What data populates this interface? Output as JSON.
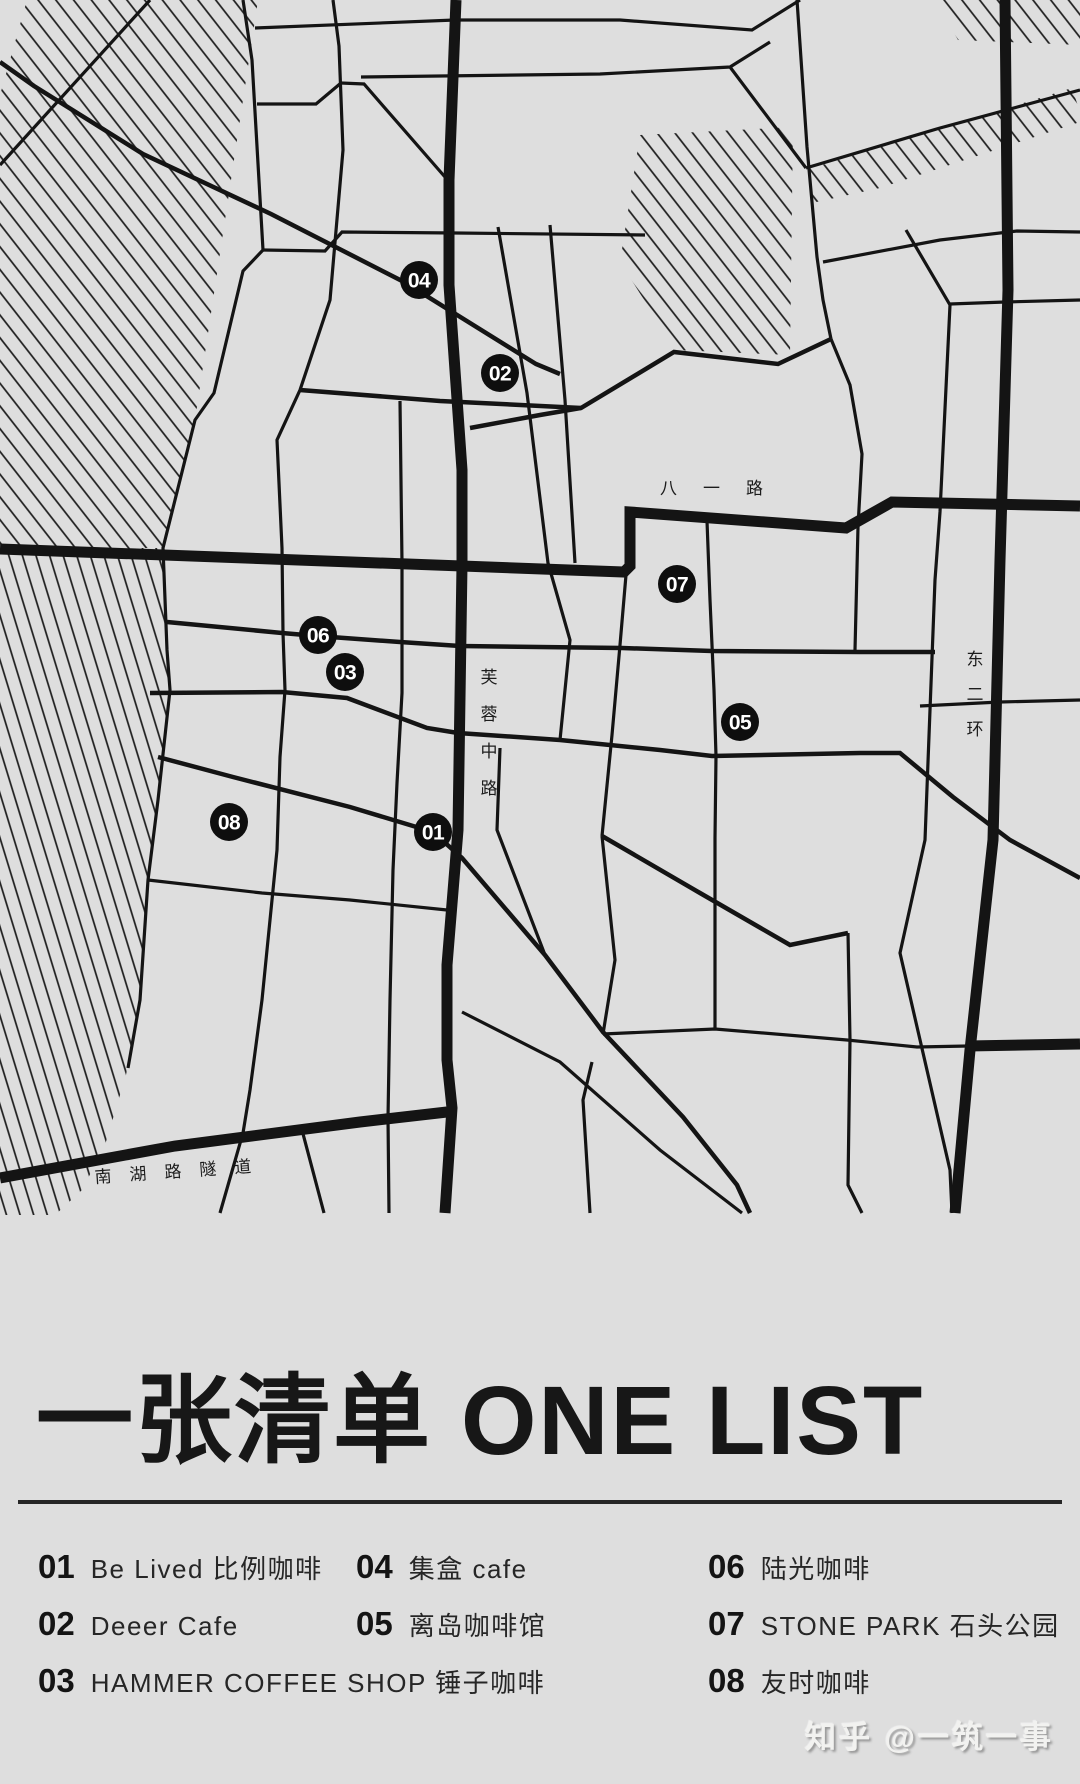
{
  "colors": {
    "background": "#dedede",
    "road": "#141414",
    "marker_fill": "#0e0e0e",
    "marker_text": "#ffffff",
    "title_text": "#171717",
    "watermark_text": "#f2f2f0"
  },
  "title": {
    "text": "一张清单 ONE LIST"
  },
  "watermark": {
    "text": "知乎 @一筑一事"
  },
  "list": {
    "columns": [
      [
        {
          "num": "01",
          "name": "Be Lived 比例咖啡"
        },
        {
          "num": "02",
          "name": "Deeer Cafe"
        },
        {
          "num": "03",
          "name": "HAMMER COFFEE SHOP 锤子咖啡"
        }
      ],
      [
        {
          "num": "04",
          "name": "集盒 cafe"
        },
        {
          "num": "05",
          "name": "离岛咖啡馆"
        }
      ],
      [
        {
          "num": "06",
          "name": "陆光咖啡"
        },
        {
          "num": "07",
          "name": "STONE PARK 石头公园"
        },
        {
          "num": "08",
          "name": "友时咖啡"
        }
      ]
    ]
  },
  "map": {
    "width": 1080,
    "height": 1216,
    "road_labels": [
      {
        "id": "bayi-road-label",
        "text": "八一路",
        "x": 660,
        "y": 494,
        "fontSize": 17,
        "letterSpacing": 26,
        "rotate": 0
      },
      {
        "id": "nanhu-tunnel-label",
        "text": "南湖路隧道",
        "x": 95,
        "y": 1183,
        "fontSize": 17,
        "letterSpacing": 18,
        "rotate": -4
      },
      {
        "id": "furong-road-label",
        "text": "芙蓉中路",
        "x": 489,
        "y": 683,
        "vertical": true,
        "step": 37,
        "fontSize": 17
      },
      {
        "id": "east-2nd-ring-label",
        "text": "东二环",
        "x": 975,
        "y": 665,
        "vertical": true,
        "step": 35,
        "fontSize": 17
      }
    ],
    "markers": [
      {
        "id": "01",
        "x": 433,
        "y": 832
      },
      {
        "id": "02",
        "x": 500,
        "y": 373
      },
      {
        "id": "03",
        "x": 345,
        "y": 672
      },
      {
        "id": "04",
        "x": 419,
        "y": 280
      },
      {
        "id": "05",
        "x": 740,
        "y": 722
      },
      {
        "id": "06",
        "x": 318,
        "y": 635
      },
      {
        "id": "07",
        "x": 677,
        "y": 584
      },
      {
        "id": "08",
        "x": 229,
        "y": 822
      }
    ],
    "marker_radius": 19,
    "hatches": [
      {
        "points": "27,0 258,0 222,240 195,420 163,548 0,548 0,95",
        "pattern": "hatch1"
      },
      {
        "points": "0,548 163,548 167,650 170,690 158,800 148,880 140,1000 126,1075 105,1145 82,1190 55,1215 0,1215",
        "pattern": "hatch2"
      },
      {
        "points": "935,0 1080,0 1080,45 958,40",
        "pattern": "hatch1"
      },
      {
        "points": "806,170 1072,88 1080,112 1080,122 880,188 812,203",
        "pattern": "hatch1"
      },
      {
        "points": "640,135 793,127 790,355 676,350 620,262",
        "pattern": "hatch1"
      }
    ],
    "roads": [
      {
        "d": "M456,0 L449,180 L449,285 L462,470 L462,565 L458,830 L447,965 L447,1060 L452,1108 L445,1213",
        "w": "thick"
      },
      {
        "d": "M0,549 L624,572 L630,566 L630,512 L846,528 L892,502 L1080,506",
        "w": "thick"
      },
      {
        "d": "M1005,0 L1008,290 L1000,560 L993,840 L970,1050 L955,1213",
        "w": "thick"
      },
      {
        "d": "M0,1178 L175,1146 L360,1122 L447,1112",
        "w": "thick"
      },
      {
        "d": "M968,1046 L1080,1044",
        "w": "thick"
      },
      {
        "d": "M0,62 L34,86 L143,154 L271,214 L404,282 L536,364 L560,374",
        "w": "med"
      },
      {
        "d": "M433,832 L462,858 L545,955 L603,1032 L683,1117 L737,1185 L750,1213",
        "w": "med"
      },
      {
        "d": "M602,836 L700,893 L790,945 L848,933",
        "w": "med"
      },
      {
        "d": "M150,693 L282,692 L347,698 L427,728 L458,733 L560,740 L660,750 L712,756 L860,753 L900,753 L953,797 L1010,840 L1080,878",
        "w": "med"
      },
      {
        "d": "M158,757 L233,777 L350,807 L433,832",
        "w": "med"
      },
      {
        "d": "M167,622 L282,633 L317,636 L400,642 L460,646 L622,648 L712,651 L860,652 L935,652",
        "w": "med"
      },
      {
        "d": "M470,428 L540,415 L581,408 L674,352 L778,364 L831,339",
        "w": "med"
      },
      {
        "d": "M300,390 L440,401 L581,408",
        "w": "med"
      },
      {
        "d": "M0,165 L150,0",
        "w": "thin"
      },
      {
        "d": "M243,0 L252,60 L263,250 L243,271 L214,393 L195,420 L163,548 L167,650 L170,690 L158,800 L148,880 L140,1000 L128,1068",
        "w": "thin"
      },
      {
        "d": "M255,28 L455,20 L620,20 L752,30 L800,0",
        "w": "thin"
      },
      {
        "d": "M333,0 L339,46 L343,150 L330,300 L300,390 L277,440 L282,548 L283,633 L285,690 L280,757 L277,850 L262,1000 L250,1090 L243,1133 L220,1213",
        "w": "thin"
      },
      {
        "d": "M361,77 L600,74 L730,67 L770,42",
        "w": "thin"
      },
      {
        "d": "M730,67 L806,168",
        "w": "thin"
      },
      {
        "d": "M797,0 L807,147 L817,257 L823,300 L831,339",
        "w": "thin"
      },
      {
        "d": "M823,262 L940,240 L1017,231 L1080,232",
        "w": "thin"
      },
      {
        "d": "M806,168 L940,128 L1080,90",
        "w": "thin"
      },
      {
        "d": "M906,230 L950,305 L940,512 L935,580 L925,840 L900,953 L950,1170 L952,1213",
        "w": "thin"
      },
      {
        "d": "M950,304 L1005,302 L1080,300",
        "w": "thin"
      },
      {
        "d": "M498,227 L527,393 L548,563 L570,640 L560,740",
        "w": "thin"
      },
      {
        "d": "M550,225 L565,400 L575,563",
        "w": "thin"
      },
      {
        "d": "M257,104 L316,104 L341,83",
        "w": "thin"
      },
      {
        "d": "M341,83 L364,84 L445,177",
        "w": "thin"
      },
      {
        "d": "M263,250 L325,251 L342,232 L456,233 L645,235",
        "w": "thin"
      },
      {
        "d": "M831,339 L850,385 L862,454 L858,527 L855,650",
        "w": "thin"
      },
      {
        "d": "M707,521 L710,600 L714,690 L716,756 L715,838 L715,1029",
        "w": "thin"
      },
      {
        "d": "M626,575 L620,645 L612,735 L602,836",
        "w": "thin"
      },
      {
        "d": "M602,836 L615,960 L603,1034",
        "w": "thin"
      },
      {
        "d": "M603,1034 L715,1029 L847,1040 L917,1047 L968,1046",
        "w": "thin"
      },
      {
        "d": "M848,933 L850,1040 L848,1185 L862,1213",
        "w": "thin"
      },
      {
        "d": "M462,1012 L560,1062 L660,1150 L742,1213",
        "w": "thin"
      },
      {
        "d": "M592,1062 L583,1100 L590,1213",
        "w": "thin"
      },
      {
        "d": "M148,880 L262,893 L350,900 L447,910",
        "w": "thin"
      },
      {
        "d": "M302,1130 L324,1213",
        "w": "thin"
      },
      {
        "d": "M400,401 L402,563 L402,693 L397,783 L393,870 L390,1000 L388,1118 L389,1213",
        "w": "thin"
      },
      {
        "d": "M500,748 L497,830 L545,955",
        "w": "thin"
      },
      {
        "d": "M920,706 L1000,702 L1080,700",
        "w": "thin"
      }
    ]
  }
}
